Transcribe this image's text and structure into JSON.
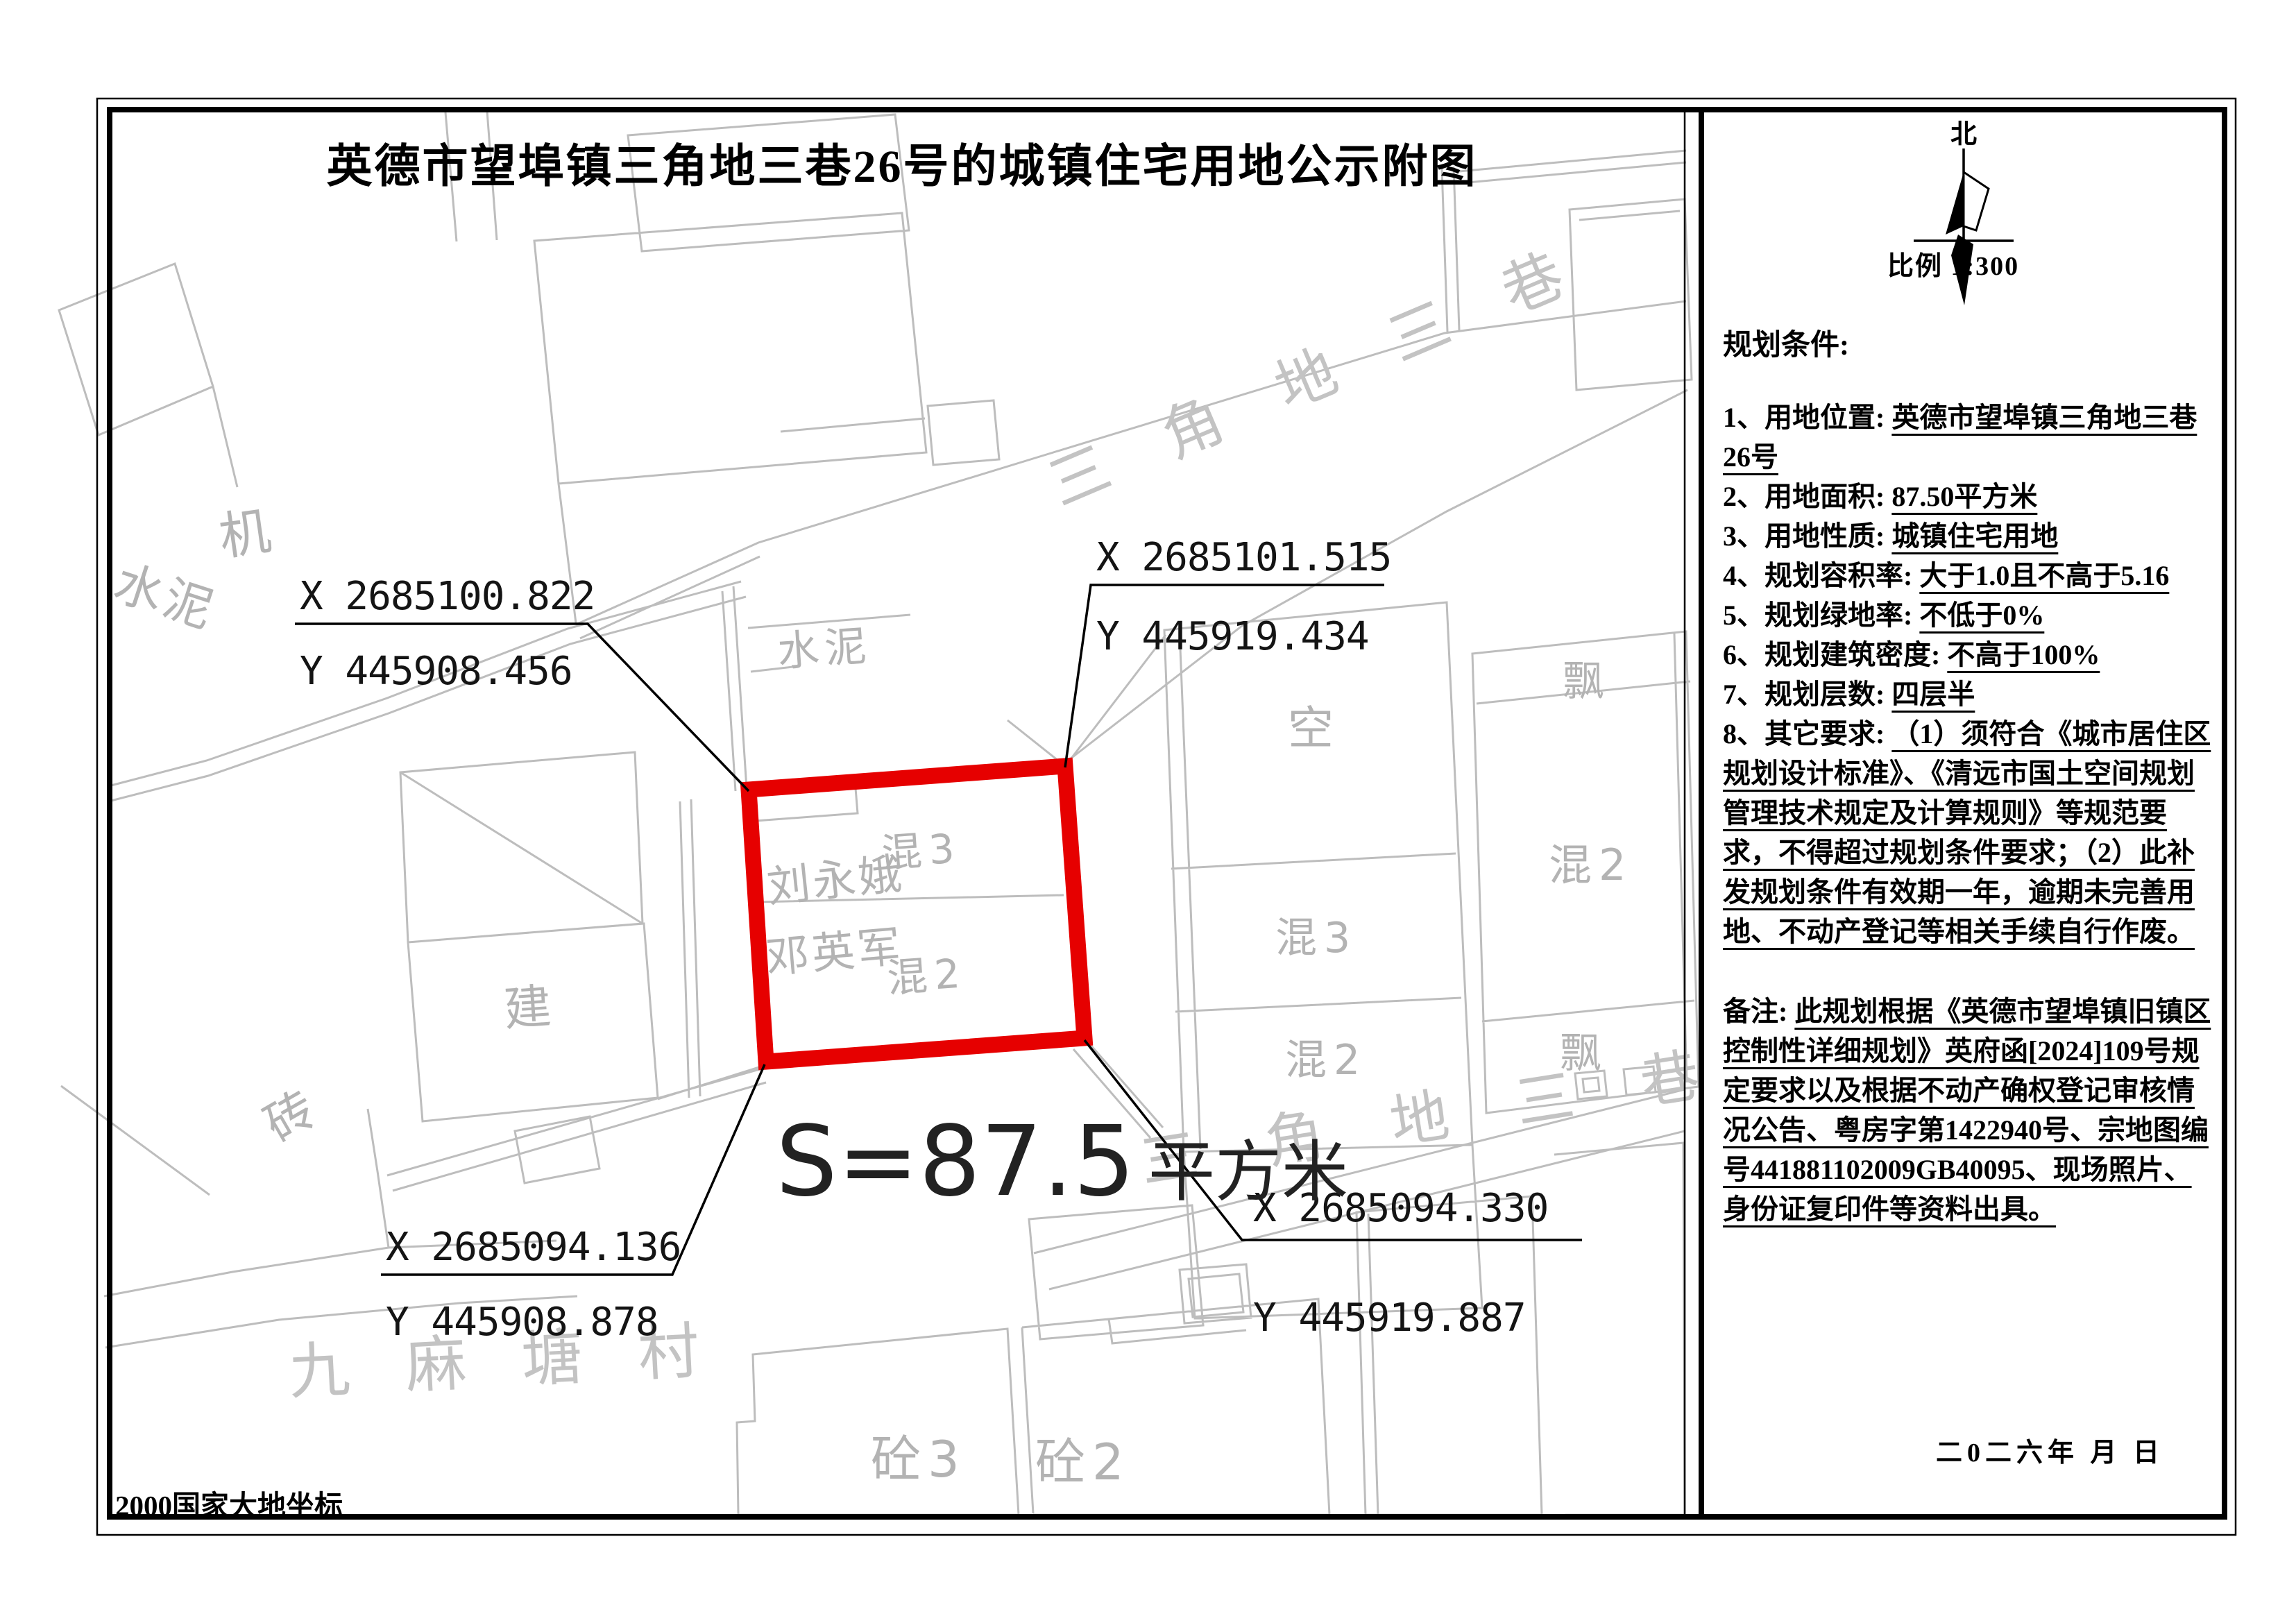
{
  "title": "英德市望埠镇三角地三巷26号的城镇住宅用地公示附图",
  "compass": {
    "north_label": "北"
  },
  "scale_label": "比例   1:300",
  "datum_note": "2000国家大地坐标",
  "area_label": {
    "prefix": "S=87.5",
    "unit": "平方米"
  },
  "corner_coords": {
    "top_left": {
      "x": "X 2685100.822",
      "y": "Y 445908.456"
    },
    "top_right": {
      "x": "X 2685101.515",
      "y": "Y 445919.434"
    },
    "bottom_left": {
      "x": "X 2685094.136",
      "y": "Y 445908.878"
    },
    "bottom_right": {
      "x": "X 2685094.330",
      "y": "Y 445919.887"
    }
  },
  "map_labels": {
    "street_top": "三 角 地 三 巷",
    "street_bottom": "三 角 地 三 巷",
    "ji": "机",
    "shuini_left": "水泥",
    "shuini_mid": "水泥",
    "jian": "建",
    "zhuan": "砖",
    "owner1": "刘永娥",
    "owner2": "邓英军",
    "hun3_parcel": "混3",
    "hun2_parcel": "混2",
    "kong": "空",
    "hun3_right": "混3",
    "hun2_right": "混2",
    "piao_top": "飘",
    "hun2_far": "混2",
    "piao_bottom": "飘",
    "village": "九 麻 塘 村",
    "tong3": "砼3",
    "tong2": "砼2"
  },
  "panel": {
    "conditions_title": "规划条件:",
    "items": [
      {
        "label": "1、用地位置: ",
        "value": "英德市望埠镇三角地三巷26号"
      },
      {
        "label": "2、用地面积: ",
        "value": "87.50平方米"
      },
      {
        "label": "3、用地性质: ",
        "value": "城镇住宅用地"
      },
      {
        "label": "4、规划容积率: ",
        "value": "大于1.0且不高于5.16"
      },
      {
        "label": "5、规划绿地率: ",
        "value": "不低于0%"
      },
      {
        "label": "6、规划建筑密度: ",
        "value": "不高于100%"
      },
      {
        "label": "7、规划层数: ",
        "value": "四层半"
      },
      {
        "label": "8、其它要求: ",
        "value": "（1）须符合《城市居住区规划设计标准》、《清远市国土空间规划管理技术规定及计算规则》等规范要求，不得超过规划条件要求；（2）此补发规划条件有效期一年，逾期未完善用地、不动产登记等相关手续自行作废。"
      }
    ],
    "notes_label": "备注: ",
    "notes_value": "此规划根据《英德市望埠镇旧镇区控制性详细规划》英府函[2024]109号规定要求以及根据不动产确权登记审核情况公告、粤房字第1422940号、宗地图编号441881102009GB40095、现场照片、身份证复印件等资料出具。",
    "date_line": "二0二六年 月 日"
  },
  "colors": {
    "parcel_red": "#e60000",
    "map_gray": "#bdbdbd",
    "ink": "#000000"
  }
}
